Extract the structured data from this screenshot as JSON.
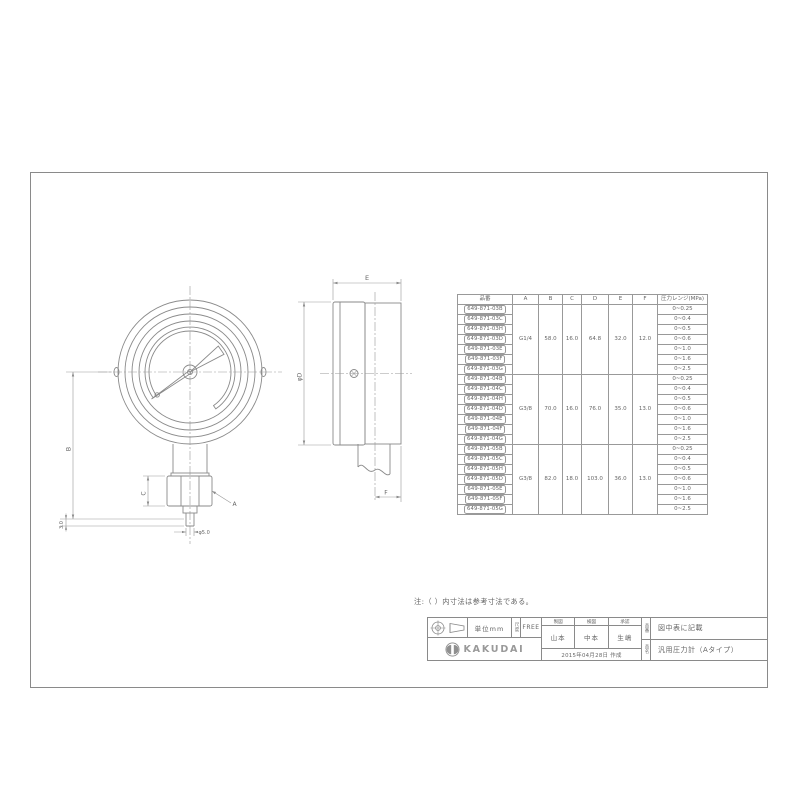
{
  "note": "注:（ ）内寸法は参考寸法である。",
  "labels": {
    "dim_b": "B",
    "dim_3": "3.0",
    "dim_c": "C",
    "dim_a": "A",
    "dim_tip": "φ5.0",
    "dim_e": "E",
    "dim_d": "φD",
    "dim_f": "F"
  },
  "table": {
    "headers": [
      "品番",
      "A",
      "B",
      "C",
      "D",
      "E",
      "F",
      "圧力レンジ(MPa)"
    ],
    "groups": [
      {
        "dims": {
          "a": "G1/4",
          "b": "58.0",
          "c": "16.0",
          "d": "64.8",
          "e": "32.0",
          "f": "12.0"
        },
        "rows": [
          {
            "part": "649-871-03B",
            "range": "0~0.25"
          },
          {
            "part": "649-871-03C",
            "range": "0~0.4"
          },
          {
            "part": "649-871-03H",
            "range": "0~0.5"
          },
          {
            "part": "649-871-03D",
            "range": "0~0.6"
          },
          {
            "part": "649-871-03E",
            "range": "0~1.0"
          },
          {
            "part": "649-871-03F",
            "range": "0~1.6"
          },
          {
            "part": "649-871-03G",
            "range": "0~2.5"
          }
        ]
      },
      {
        "dims": {
          "a": "G3/8",
          "b": "70.0",
          "c": "16.0",
          "d": "76.0",
          "e": "35.0",
          "f": "13.0"
        },
        "rows": [
          {
            "part": "649-871-04B",
            "range": "0~0.25"
          },
          {
            "part": "649-871-04C",
            "range": "0~0.4"
          },
          {
            "part": "649-871-04H",
            "range": "0~0.5"
          },
          {
            "part": "649-871-04D",
            "range": "0~0.6"
          },
          {
            "part": "649-871-04E",
            "range": "0~1.0"
          },
          {
            "part": "649-871-04F",
            "range": "0~1.6"
          },
          {
            "part": "649-871-04G",
            "range": "0~2.5"
          }
        ]
      },
      {
        "dims": {
          "a": "G3/8",
          "b": "82.0",
          "c": "18.0",
          "d": "103.0",
          "e": "36.0",
          "f": "13.0"
        },
        "rows": [
          {
            "part": "649-871-05B",
            "range": "0~0.25"
          },
          {
            "part": "649-871-05C",
            "range": "0~0.4"
          },
          {
            "part": "649-871-05H",
            "range": "0~0.5"
          },
          {
            "part": "649-871-05D",
            "range": "0~0.6"
          },
          {
            "part": "649-871-05E",
            "range": "0~1.0"
          },
          {
            "part": "649-871-05F",
            "range": "0~1.6"
          },
          {
            "part": "649-871-05G",
            "range": "0~2.5"
          }
        ]
      }
    ]
  },
  "title_block": {
    "unit": "単位mm",
    "scale_label": "尺度",
    "scale_value": "FREE",
    "brand": "KAKUDAI",
    "sign_cols": [
      {
        "role": "製図",
        "name": "山本"
      },
      {
        "role": "検図",
        "name": "中本"
      },
      {
        "role": "承認",
        "name": "生嶋"
      }
    ],
    "date": "2015年04月28日 作成",
    "part_label": "品番",
    "part_value": "図中表に記載",
    "name_label": "品名",
    "name_value": "汎用圧力計（Aタイプ）"
  }
}
